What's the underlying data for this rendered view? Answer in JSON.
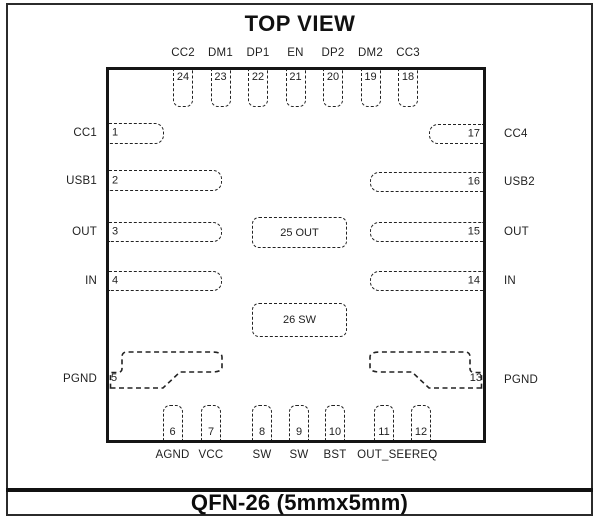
{
  "title": "TOP VIEW",
  "package_label": "QFN-26 (5mmx5mm)",
  "pins": {
    "top": [
      {
        "num": "24",
        "name": "CC2"
      },
      {
        "num": "23",
        "name": "DM1"
      },
      {
        "num": "22",
        "name": "DP1"
      },
      {
        "num": "21",
        "name": "EN"
      },
      {
        "num": "20",
        "name": "DP2"
      },
      {
        "num": "19",
        "name": "DM2"
      },
      {
        "num": "18",
        "name": "CC3"
      }
    ],
    "bottom": [
      {
        "num": "6",
        "name": "AGND"
      },
      {
        "num": "7",
        "name": "VCC"
      },
      {
        "num": "8",
        "name": "SW"
      },
      {
        "num": "9",
        "name": "SW"
      },
      {
        "num": "10",
        "name": "BST"
      },
      {
        "num": "11",
        "name": "OUT_SEL"
      },
      {
        "num": "12",
        "name": "FREQ"
      }
    ],
    "left": [
      {
        "num": "1",
        "name": "CC1"
      },
      {
        "num": "2",
        "name": "USB1"
      },
      {
        "num": "3",
        "name": "OUT"
      },
      {
        "num": "4",
        "name": "IN"
      },
      {
        "num": "5",
        "name": "PGND"
      }
    ],
    "right": [
      {
        "num": "17",
        "name": "CC4"
      },
      {
        "num": "16",
        "name": "USB2"
      },
      {
        "num": "15",
        "name": "OUT"
      },
      {
        "num": "14",
        "name": "IN"
      },
      {
        "num": "13",
        "name": "PGND"
      }
    ],
    "center": [
      {
        "num": "25",
        "name": "OUT"
      },
      {
        "num": "26",
        "name": "SW"
      }
    ]
  },
  "colors": {
    "line": "#222222",
    "chip_border": "#151515",
    "frame_border": "#2b2b2b",
    "text": "#1f1f1f",
    "background": "#ffffff"
  }
}
